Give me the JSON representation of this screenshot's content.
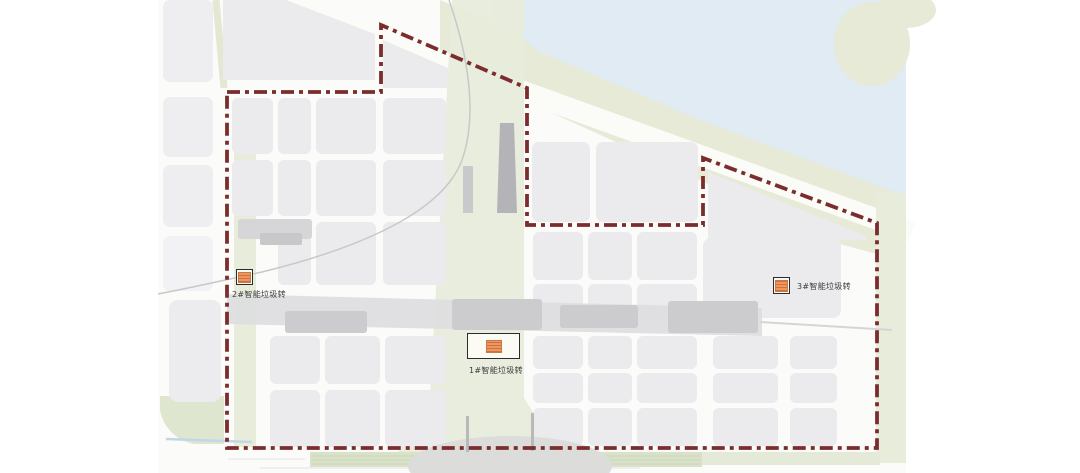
{
  "map": {
    "markers": [
      {
        "name": "station-1",
        "label": "1#智能垃圾转"
      },
      {
        "name": "station-2",
        "label": "2#智能垃圾转"
      },
      {
        "name": "station-3",
        "label": "3#智能垃圾转"
      }
    ],
    "colors": {
      "boundary_dash": "#7b2d2d",
      "water": "#e0ebf3",
      "green_bank": "#e6ead6",
      "greenway": "#e7ecdb",
      "block": "#ebebed",
      "road": "#fbfbf7",
      "structure_gray": "#dddddf",
      "marker_orange": "#ef9560"
    }
  }
}
